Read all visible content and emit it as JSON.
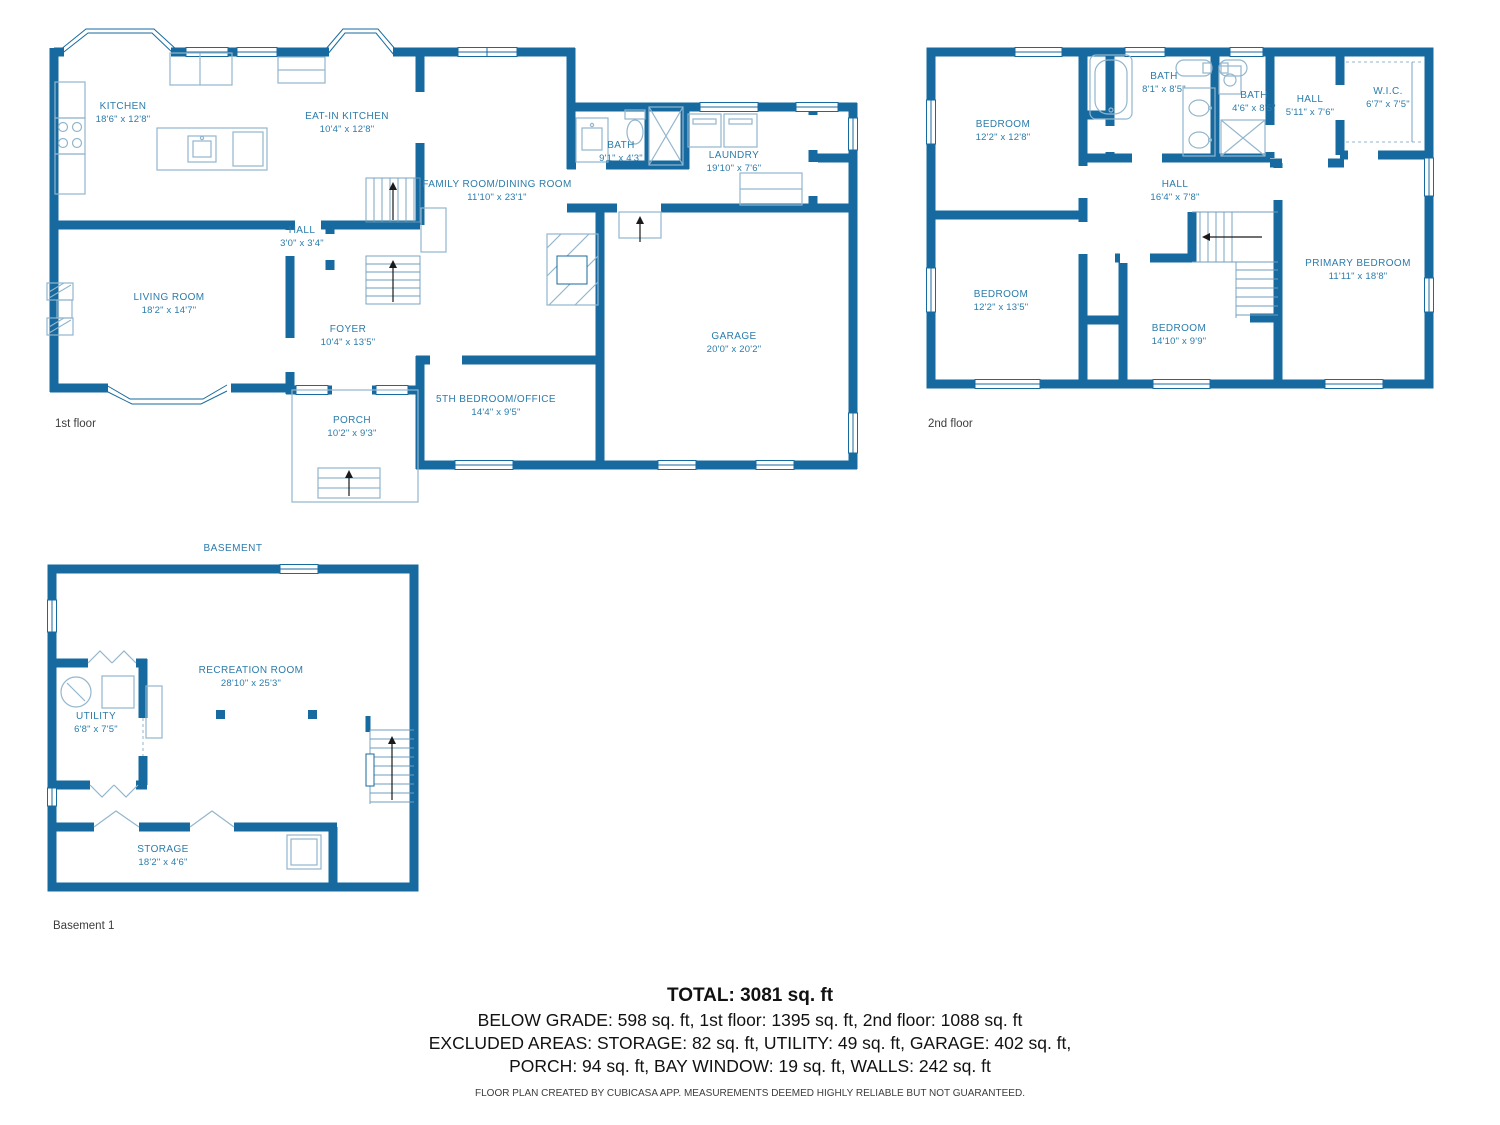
{
  "colors": {
    "wall": "#176A9F",
    "label": "#2b7cab",
    "fixture": "#93b6cd",
    "text": "#111111"
  },
  "floors": {
    "first": {
      "label": "1st floor",
      "rooms": [
        {
          "name": "KITCHEN",
          "dims": "18'6\" x 12'8\""
        },
        {
          "name": "EAT-IN KITCHEN",
          "dims": "10'4\" x 12'8\""
        },
        {
          "name": "FAMILY ROOM/DINING ROOM",
          "dims": "11'10\" x 23'1\""
        },
        {
          "name": "BATH",
          "dims": "9'1\" x 4'3\""
        },
        {
          "name": "LAUNDRY",
          "dims": "19'10\" x 7'6\""
        },
        {
          "name": "HALL",
          "dims": "3'0\" x 3'4\""
        },
        {
          "name": "LIVING ROOM",
          "dims": "18'2\" x 14'7\""
        },
        {
          "name": "FOYER",
          "dims": "10'4\" x 13'5\""
        },
        {
          "name": "GARAGE",
          "dims": "20'0\" x 20'2\""
        },
        {
          "name": "5TH BEDROOM/OFFICE",
          "dims": "14'4\" x 9'5\""
        },
        {
          "name": "PORCH",
          "dims": "10'2\" x 9'3\""
        }
      ]
    },
    "second": {
      "label": "2nd floor",
      "rooms": [
        {
          "name": "BEDROOM",
          "dims": "12'2\" x 12'8\""
        },
        {
          "name": "BATH",
          "dims": "8'1\" x 8'5\""
        },
        {
          "name": "BATH",
          "dims": "4'6\" x 8'5\""
        },
        {
          "name": "HALL",
          "dims": "5'11\" x 7'6\""
        },
        {
          "name": "W.I.C.",
          "dims": "6'7\" x 7'5\""
        },
        {
          "name": "HALL",
          "dims": "16'4\" x 7'8\""
        },
        {
          "name": "BEDROOM",
          "dims": "12'2\" x 13'5\""
        },
        {
          "name": "BEDROOM",
          "dims": "14'10\" x 9'9\""
        },
        {
          "name": "PRIMARY BEDROOM",
          "dims": "11'11\" x 18'8\""
        }
      ]
    },
    "basement": {
      "title": "BASEMENT",
      "label": "Basement 1",
      "rooms": [
        {
          "name": "RECREATION ROOM",
          "dims": "28'10\" x 25'3\""
        },
        {
          "name": "UTILITY",
          "dims": "6'8\" x 7'5\""
        },
        {
          "name": "STORAGE",
          "dims": "18'2\" x 4'6\""
        }
      ]
    }
  },
  "summary": {
    "total": "TOTAL: 3081 sq. ft",
    "line1": "BELOW GRADE: 598 sq. ft, 1st floor: 1395 sq. ft, 2nd floor: 1088 sq. ft",
    "line2": "EXCLUDED AREAS: STORAGE: 82 sq. ft, UTILITY: 49 sq. ft, GARAGE: 402 sq. ft,",
    "line3": "PORCH: 94 sq. ft, BAY WINDOW: 19 sq. ft, WALLS: 242 sq. ft",
    "disclaimer": "FLOOR PLAN CREATED BY CUBICASA APP. MEASUREMENTS DEEMED HIGHLY RELIABLE BUT NOT GUARANTEED."
  }
}
